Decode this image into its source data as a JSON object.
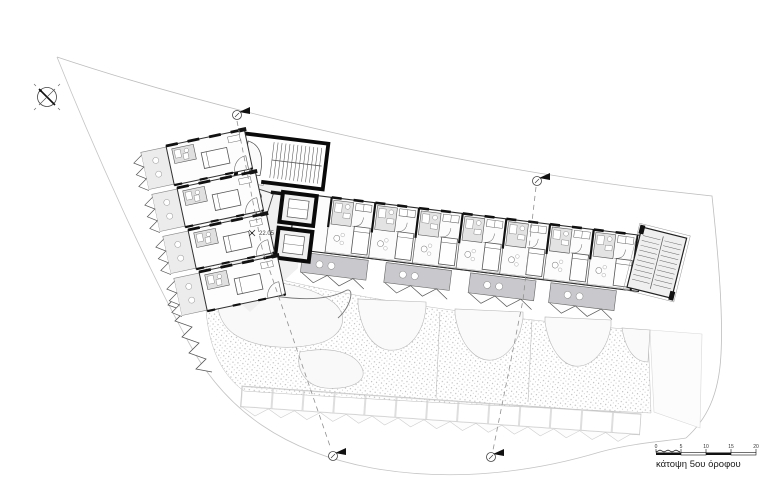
{
  "drawing": {
    "caption": "κάτοψη 5ου όροφου",
    "spot_elevation": "22.05",
    "scale_bar": {
      "labels": [
        "0",
        "5",
        "10",
        "15",
        "20"
      ]
    }
  },
  "colors": {
    "wall_black": "#111111",
    "awning_gray": "#c9c9cd",
    "light_fill": "#ececec",
    "boundary_gray": "#bdbdbd"
  },
  "icons": {
    "north": "north-arrow-icon",
    "section_marker": "section-marker-icon"
  }
}
